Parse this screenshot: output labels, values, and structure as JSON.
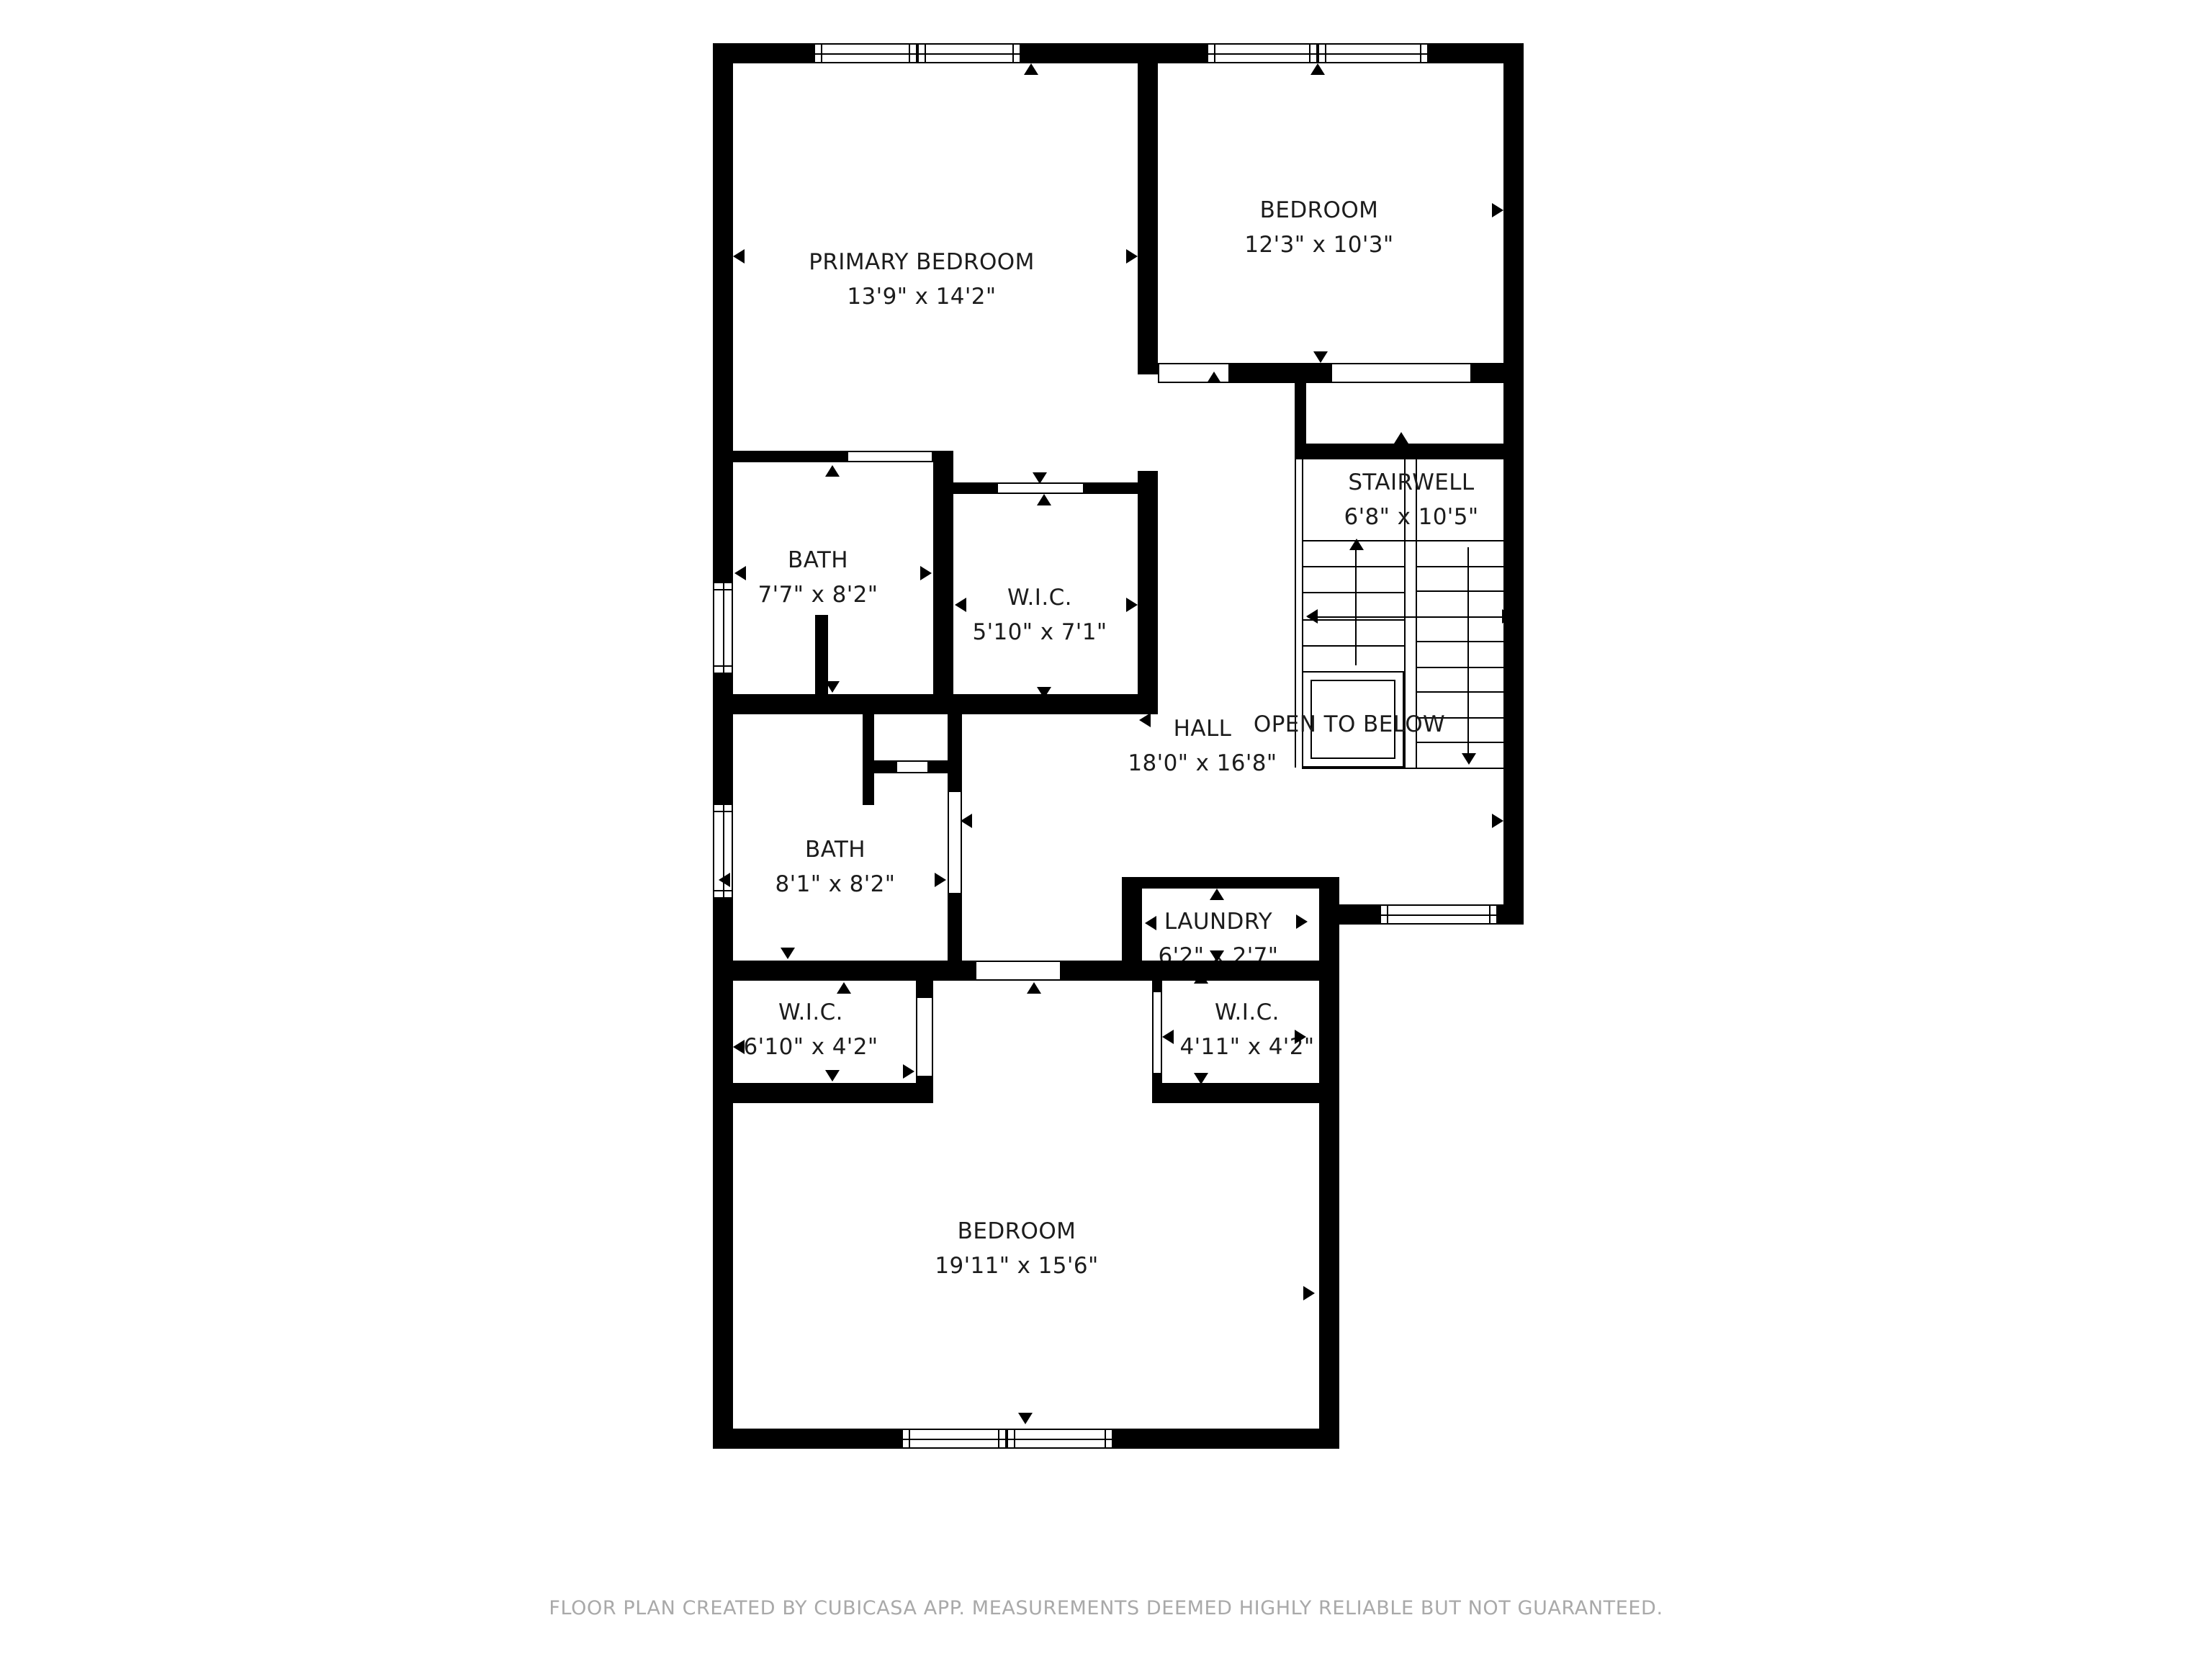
{
  "icons": {
    "door-swing-up-icon": "▲",
    "door-swing-down-icon": "▼",
    "measure-left-icon": "◀",
    "measure-right-icon": "▶"
  },
  "rooms": [
    {
      "id": "primary-bedroom",
      "name": "PRIMARY BEDROOM",
      "dims": "13'9\" x 14'2\""
    },
    {
      "id": "bedroom-top",
      "name": "BEDROOM",
      "dims": "12'3\" x 10'3\""
    },
    {
      "id": "stairwell",
      "name": "STAIRWELL",
      "dims": "6'8\" x 10'5\""
    },
    {
      "id": "bath-upper",
      "name": "BATH",
      "dims": "7'7\" x 8'2\""
    },
    {
      "id": "wic-upper",
      "name": "W.I.C.",
      "dims": "5'10\" x 7'1\""
    },
    {
      "id": "hall",
      "name": "HALL",
      "dims": "18'0\" x 16'8\""
    },
    {
      "id": "open-to-below",
      "name": "OPEN TO BELOW",
      "dims": ""
    },
    {
      "id": "bath-lower",
      "name": "BATH",
      "dims": "8'1\" x 8'2\""
    },
    {
      "id": "laundry",
      "name": "LAUNDRY",
      "dims": "6'2\" x 2'7\""
    },
    {
      "id": "wic-left",
      "name": "W.I.C.",
      "dims": "6'10\" x 4'2\""
    },
    {
      "id": "wic-right",
      "name": "W.I.C.",
      "dims": "4'11\" x 4'2\""
    },
    {
      "id": "bedroom-bottom",
      "name": "BEDROOM",
      "dims": "19'11\" x 15'6\""
    }
  ],
  "footer": {
    "text": "FLOOR PLAN CREATED BY CUBICASA APP. MEASUREMENTS DEEMED HIGHLY RELIABLE BUT NOT GUARANTEED."
  }
}
